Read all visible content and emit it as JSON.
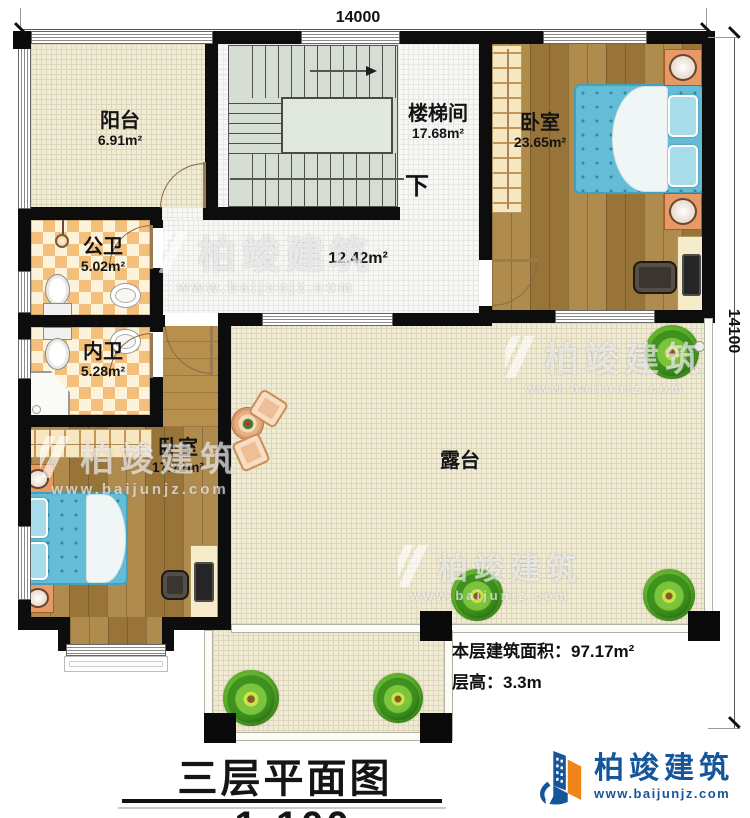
{
  "dim_top": "14000",
  "dim_right": "14100",
  "rooms": {
    "balcony": {
      "name": "阳台",
      "area": "6.91m²"
    },
    "stairwell": {
      "name": "楼梯间",
      "area": "17.68m²"
    },
    "stairs_down": "下",
    "bedroom_top": {
      "name": "卧室",
      "area": "23.65m²"
    },
    "public_bath": {
      "name": "公卫",
      "area": "5.02m²"
    },
    "private_bath": {
      "name": "内卫",
      "area": "5.28m²"
    },
    "hallway": {
      "area": "12.42m²"
    },
    "bedroom_bottom": {
      "name": "卧室",
      "area": "17.72m²"
    },
    "terrace": {
      "name": "露台"
    }
  },
  "annotations": {
    "floor_area": "本层建筑面积：97.17m²",
    "floor_height": "层高：3.3m"
  },
  "title": {
    "text": "三层平面图",
    "scale": "1:100"
  },
  "logo": {
    "name": "柏竣建筑",
    "url": "www.baijunjz.com"
  },
  "watermark": {
    "name": "柏竣建筑",
    "url": "www.baijunjz.com"
  },
  "colors": {
    "wall": "#0d0d0d",
    "wood": "#a9813f",
    "tile": "#f0ebd5",
    "checker": "#f3c07c",
    "bed": "#64bdd6",
    "logo_blue": "#15559a",
    "logo_orange": "#f08519"
  }
}
